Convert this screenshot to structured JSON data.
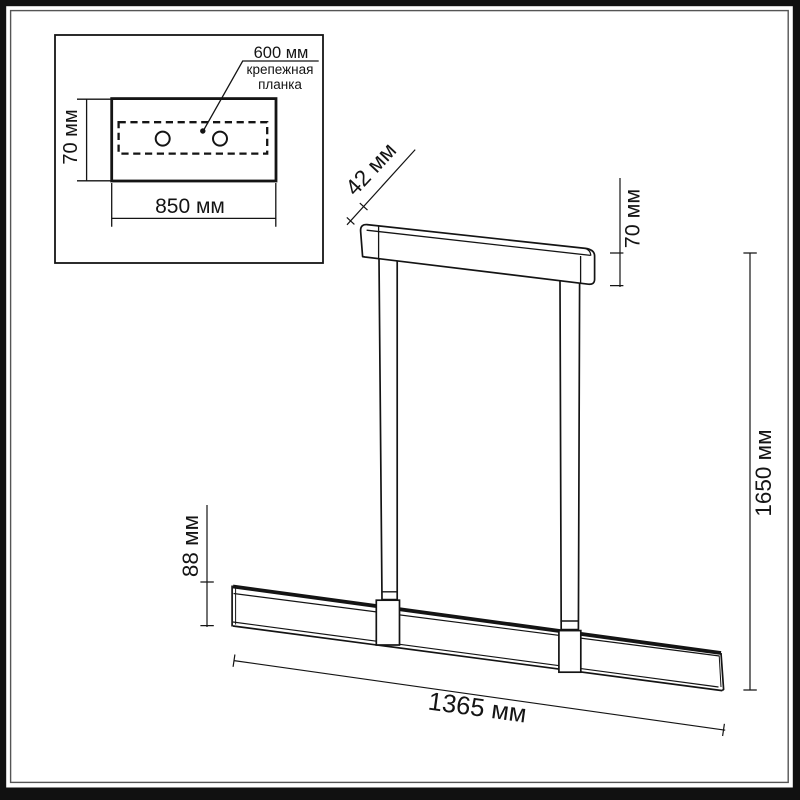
{
  "drawing": {
    "units": "мм",
    "inset": {
      "plate_width": "850 мм",
      "plate_height": "70 мм",
      "hole_spacing": "600 мм",
      "plate_caption": "крепежная планка"
    },
    "dimensions": {
      "canopy_depth": "42 мм",
      "canopy_height": "70 мм",
      "overall_height": "1650 мм",
      "bar_height": "88 мм",
      "bar_length": "1365 мм"
    },
    "colors": {
      "line": "#141414",
      "frame": "#111111",
      "inner_frame": "#555555",
      "background": "#ffffff"
    }
  }
}
